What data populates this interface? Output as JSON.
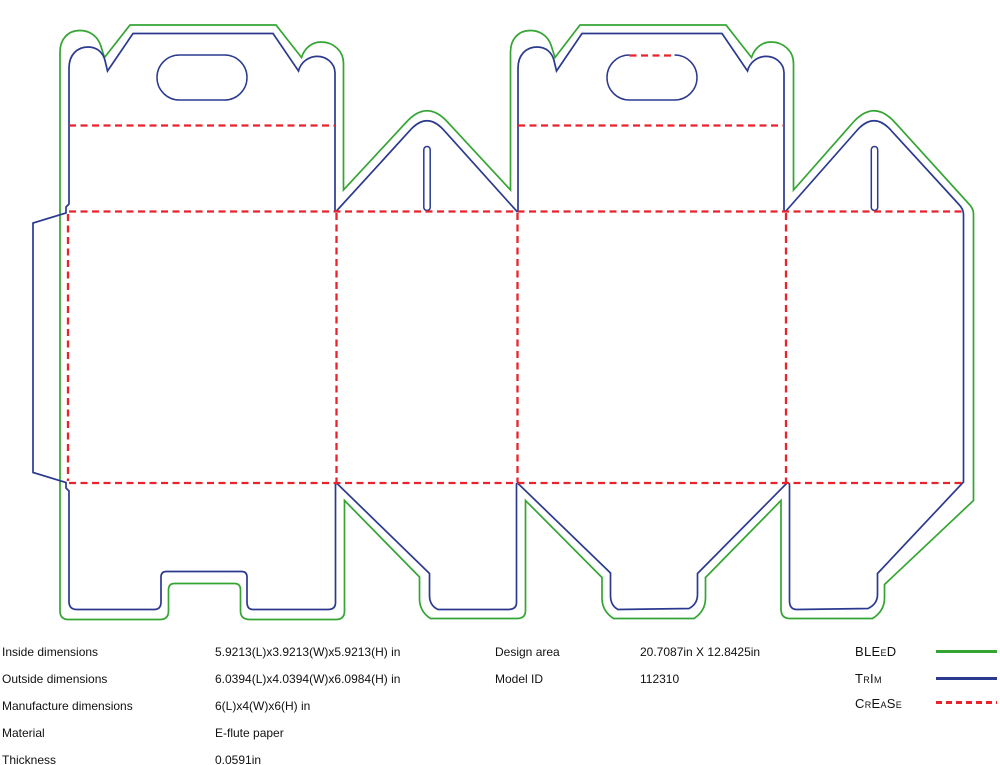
{
  "colors": {
    "bleed": "#34A533",
    "trim": "#2B3A8F",
    "crease": "#E8232B",
    "background": "#FFFFFF",
    "text": "#111111"
  },
  "info": {
    "rows": [
      {
        "label": "Inside dimensions",
        "value": "5.9213(L)x3.9213(W)x5.9213(H) in"
      },
      {
        "label": "Outside dimensions",
        "value": "6.0394(L)x4.0394(W)x6.0984(H) in"
      },
      {
        "label": "Manufacture dimensions",
        "value": "6(L)x4(W)x6(H) in"
      },
      {
        "label": "Material",
        "value": "E-flute paper"
      },
      {
        "label": "Thickness",
        "value": "0.0591in"
      }
    ],
    "meta": [
      {
        "label": "Design area",
        "value": "20.7087in X 12.8425in"
      },
      {
        "label": "Model ID",
        "value": "112310"
      }
    ]
  },
  "legend": [
    {
      "label": "BLEeD",
      "style": "solid",
      "color": "#34A533"
    },
    {
      "label": "TrIm",
      "style": "solid",
      "color": "#2B3A8F"
    },
    {
      "label": "CrEaSe",
      "style": "dashed",
      "color": "#E8232B"
    }
  ]
}
